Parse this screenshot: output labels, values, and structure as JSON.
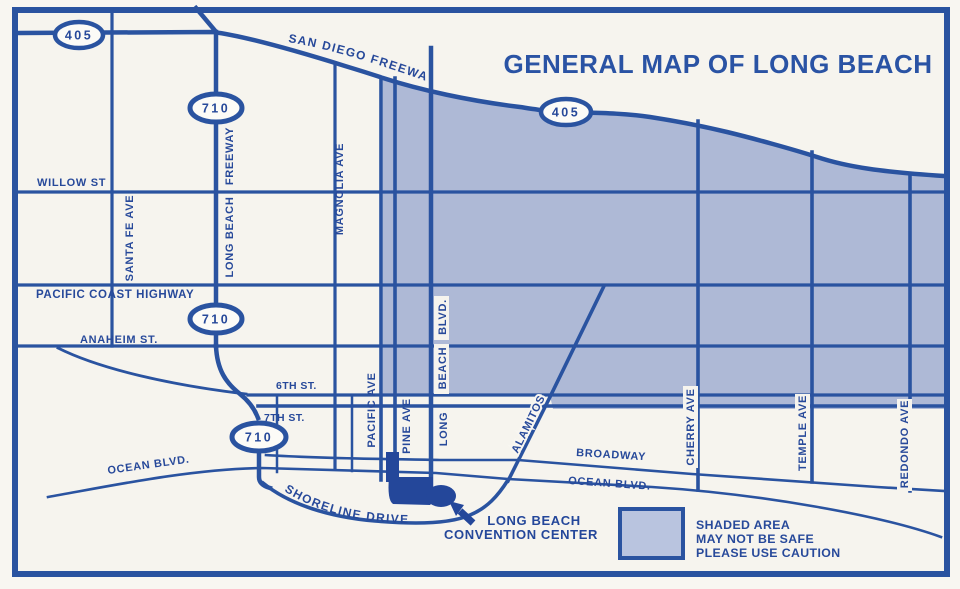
{
  "title": "GENERAL MAP OF LONG BEACH",
  "route_shields": {
    "i405_northwest": "405",
    "i405_central": "405",
    "i710_north": "710",
    "i710_mid": "710",
    "i710_south": "710"
  },
  "streets": {
    "san_diego_freeway": "SAN DIEGO FREEWAY",
    "willow": "WILLOW ST",
    "pacific_coast_highway": "PACIFIC COAST HIGHWAY",
    "anaheim": "ANAHEIM ST.",
    "sixth": "6TH ST.",
    "seventh": "7TH ST.",
    "broadway": "BROADWAY",
    "ocean_west": "OCEAN BLVD.",
    "ocean_east": "OCEAN BLVD.",
    "shoreline": "SHORELINE DRIVE",
    "santa_fe": "SANTA FE AVE",
    "long_beach_freeway_name": "LONG BEACH",
    "long_beach_freeway_suffix": "FREEWAY",
    "magnolia": "MAGNOLIA AVE",
    "pacific": "PACIFIC AVE",
    "pine": "PINE AVE",
    "long_beach_blvd_long": "LONG",
    "long_beach_blvd_beach": "BEACH",
    "long_beach_blvd_blvd": "BLVD.",
    "alamitos": "ALAMITOS",
    "cherry": "CHERRY AVE",
    "temple": "TEMPLE AVE",
    "redondo": "REDONDO AVE"
  },
  "landmark": {
    "line1": "LONG BEACH",
    "line2": "CONVENTION CENTER"
  },
  "legend": {
    "line1": "SHADED AREA",
    "line2": "MAY NOT BE SAFE",
    "line3": "PLEASE USE CAUTION"
  },
  "colors": {
    "ink": "#2a53a0",
    "text": "#27499a",
    "shaded_area": "#aeb9d6",
    "legend_swatch": "#b9c4df",
    "paper": "#f8f6f1"
  }
}
